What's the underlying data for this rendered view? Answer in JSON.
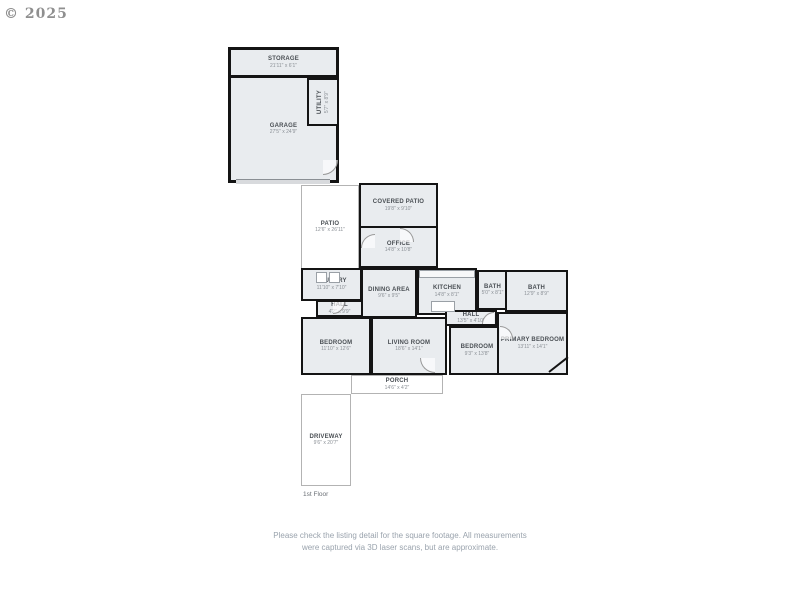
{
  "watermark": "© 2025",
  "floor_label": "1st Floor",
  "rooms": [
    {
      "name": "STORAGE",
      "dims": "21'11\" x 6'1\""
    },
    {
      "name": "GARAGE",
      "dims": "27'5\" x 24'9\""
    },
    {
      "name": "UTILITY",
      "dims": "5'7\" x 8'9\""
    },
    {
      "name": "COVERED PATIO",
      "dims": "19'8\" x 9'10\""
    },
    {
      "name": "PATIO",
      "dims": "12'6\" x 26'11\""
    },
    {
      "name": "OFFICE",
      "dims": "14'8\" x 10'8\""
    },
    {
      "name": "LAUNDRY",
      "dims": "11'10\" x 7'10\""
    },
    {
      "name": "DINING AREA",
      "dims": "9'6\" x 9'5\""
    },
    {
      "name": "KITCHEN",
      "dims": "14'8\" x 8'1\""
    },
    {
      "name": "BATH",
      "dims": "5'0\" x 8'1\""
    },
    {
      "name": "BATH",
      "dims": "12'9\" x 8'9\""
    },
    {
      "name": "HALL",
      "dims": "4'2\" x 9'9\""
    },
    {
      "name": "HALL",
      "dims": "13'5\" x 4'10\""
    },
    {
      "name": "BEDROOM",
      "dims": "11'10\" x 12'6\""
    },
    {
      "name": "LIVING ROOM",
      "dims": "18'6\" x 14'1\""
    },
    {
      "name": "BEDROOM",
      "dims": "9'3\" x 13'8\""
    },
    {
      "name": "PRIMARY BEDROOM",
      "dims": "13'11\" x 14'1\""
    },
    {
      "name": "PORCH",
      "dims": "14'6\" x 4'2\""
    },
    {
      "name": "DRIVEWAY",
      "dims": "9'6\" x 20'7\""
    }
  ],
  "footer": {
    "line1": "Please check the listing detail for the square footage. All measurements",
    "line2": "were captured via 3D laser scans, but are approximate."
  },
  "colors": {
    "wall": "#141414",
    "room_fill": "#e9ecef",
    "footer_text": "#9aa3ad"
  }
}
